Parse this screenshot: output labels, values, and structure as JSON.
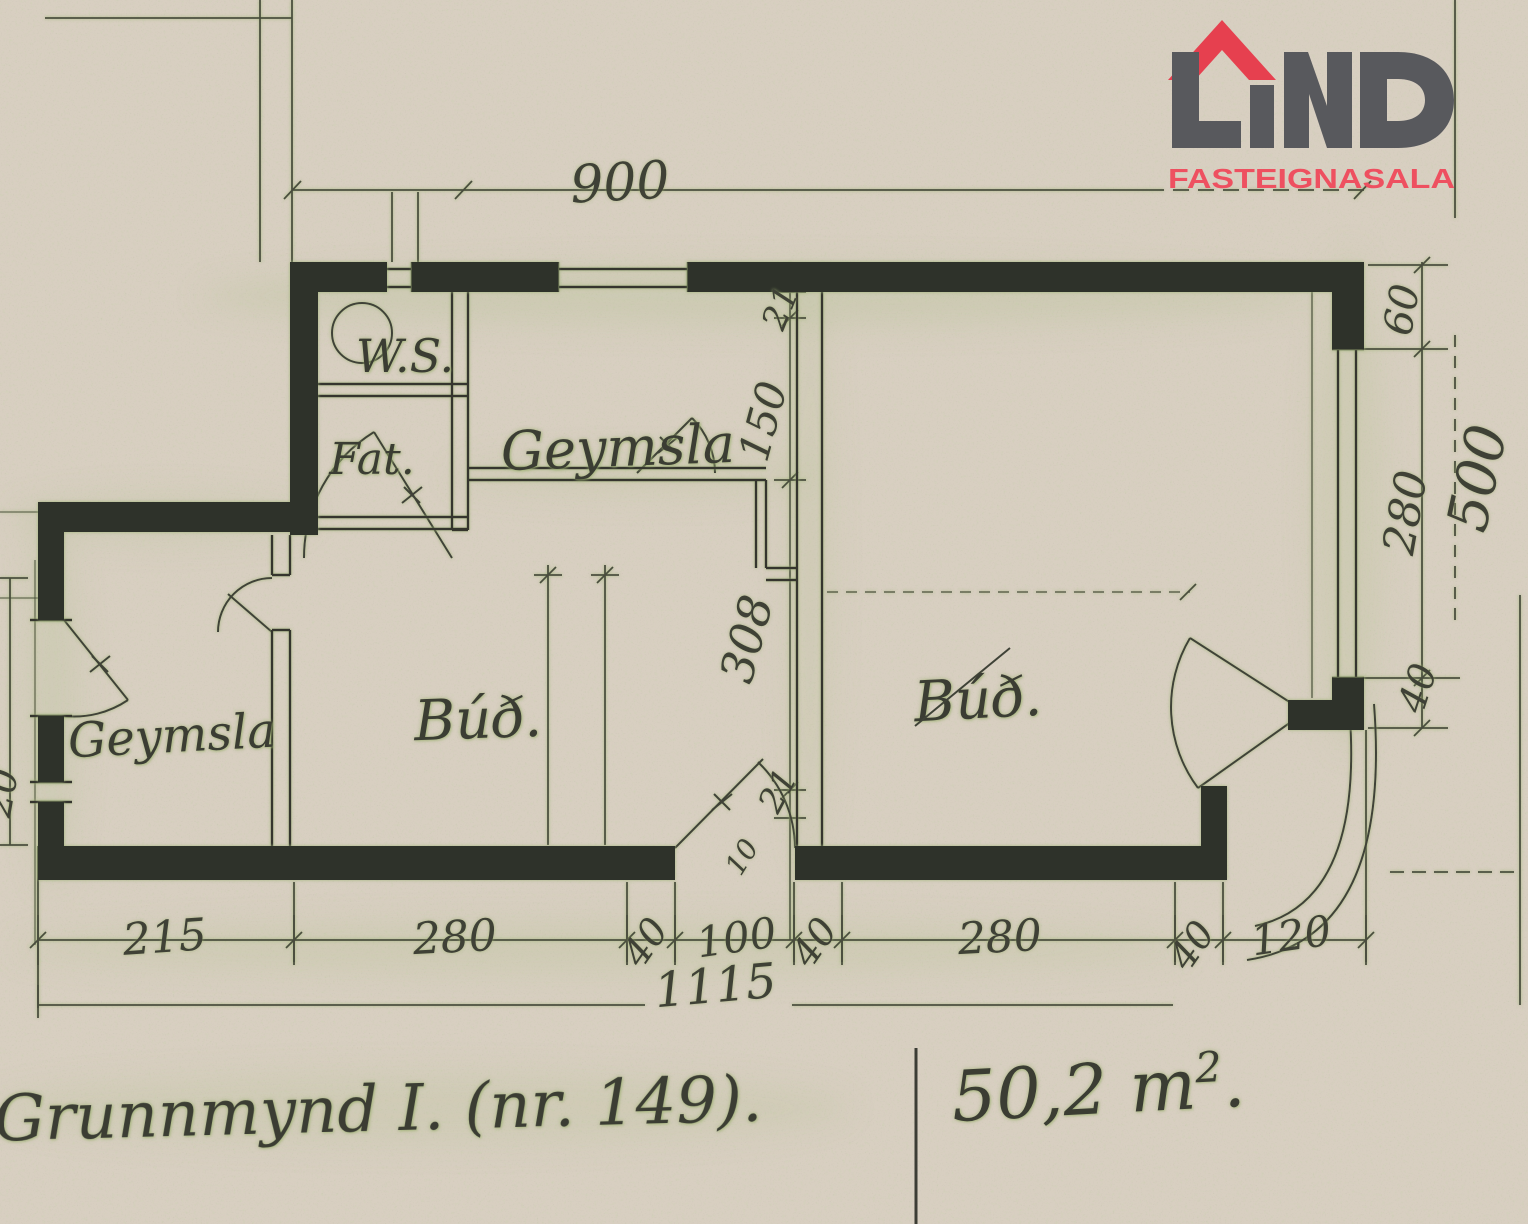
{
  "logo": {
    "name": "LIND",
    "tagline": "FASTEIGNASALA",
    "letter_color": "#58595d",
    "roof_color": "#e6404f",
    "tagline_color": "#ee5060"
  },
  "colors": {
    "paper": "#d8cfc1",
    "ink_wall": "#2f302a",
    "pencil": "#4a4d3e",
    "highlight_green": "#a9bc85"
  },
  "rooms": [
    {
      "id": "ws",
      "label": "W.S."
    },
    {
      "id": "fat",
      "label": "Fat."
    },
    {
      "id": "geymsla_top",
      "label": "Geymsla"
    },
    {
      "id": "bud_left",
      "label": "Búð."
    },
    {
      "id": "geymsla_left",
      "label": "Geymsla"
    },
    {
      "id": "bud_right",
      "label": "Búð."
    }
  ],
  "dimensions": {
    "top_width": "900",
    "right_chain": [
      "60",
      "280",
      "40"
    ],
    "right_total": "500",
    "center_chain": [
      "21",
      "150",
      "308",
      "21"
    ],
    "center_extra": "10",
    "left_gap": "20",
    "bottom_chain": [
      "215",
      "280",
      "40",
      "100",
      "40",
      "280",
      "40",
      "120"
    ],
    "bottom_total": "1115"
  },
  "captions": {
    "title": "Grunnmynd I. (nr. 149).",
    "area": "50,2 m",
    "area_sup": "2",
    "area_tail": "."
  }
}
